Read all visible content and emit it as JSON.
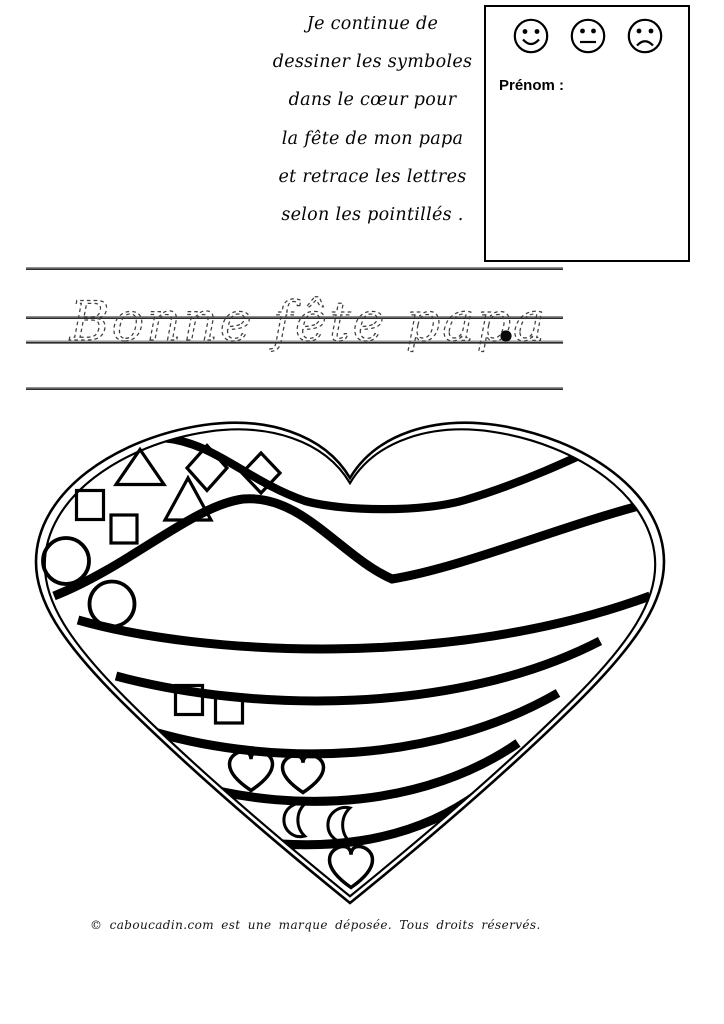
{
  "colors": {
    "ink": "#000000",
    "rule_dark": "#2b2b2b",
    "rule_light": "#8f8f8f",
    "trace": "#3f3f3f"
  },
  "instructions": {
    "lines": [
      "Je continue de",
      "dessiner les symboles",
      "dans le cœur pour",
      "la fête de mon papa",
      "et retrace les lettres",
      "selon les pointillés ."
    ]
  },
  "name_box": {
    "label": "Prénom :",
    "smileys": [
      "happy-face-icon",
      "neutral-face-icon",
      "sad-face-icon"
    ]
  },
  "tracing": {
    "text": "Bonne fête papa",
    "end_dot": ".",
    "rule_count": 4
  },
  "heart": {
    "shapes": [
      {
        "type": "triangle",
        "cx": 140,
        "cy": 467,
        "w": 48,
        "h": 35
      },
      {
        "type": "triangle",
        "cx": 188,
        "cy": 499,
        "w": 46,
        "h": 42
      },
      {
        "type": "diamond",
        "cx": 207,
        "cy": 468,
        "w": 40,
        "h": 45
      },
      {
        "type": "diamond",
        "cx": 261,
        "cy": 473,
        "w": 38,
        "h": 40
      },
      {
        "type": "square",
        "cx": 90,
        "cy": 505,
        "w": 27,
        "h": 29
      },
      {
        "type": "square",
        "cx": 124,
        "cy": 529,
        "w": 26,
        "h": 28
      },
      {
        "type": "circle",
        "cx": 66,
        "cy": 561,
        "w": 46,
        "h": 46
      },
      {
        "type": "circle",
        "cx": 112,
        "cy": 604,
        "w": 45,
        "h": 45
      },
      {
        "type": "square",
        "cx": 189,
        "cy": 700,
        "w": 27,
        "h": 29
      },
      {
        "type": "square",
        "cx": 229,
        "cy": 709,
        "w": 27,
        "h": 28
      },
      {
        "type": "heart",
        "cx": 251,
        "cy": 771,
        "w": 43,
        "h": 39
      },
      {
        "type": "heart",
        "cx": 303,
        "cy": 774,
        "w": 41,
        "h": 37
      },
      {
        "type": "moon",
        "cx": 300,
        "cy": 820,
        "w": 26,
        "h": 35
      },
      {
        "type": "moon",
        "cx": 345,
        "cy": 825,
        "w": 27,
        "h": 37
      },
      {
        "type": "heart",
        "cx": 351,
        "cy": 867,
        "w": 43,
        "h": 41
      }
    ]
  },
  "footer": {
    "text": "© caboucadin.com est une marque déposée.  Tous droits réservés."
  }
}
